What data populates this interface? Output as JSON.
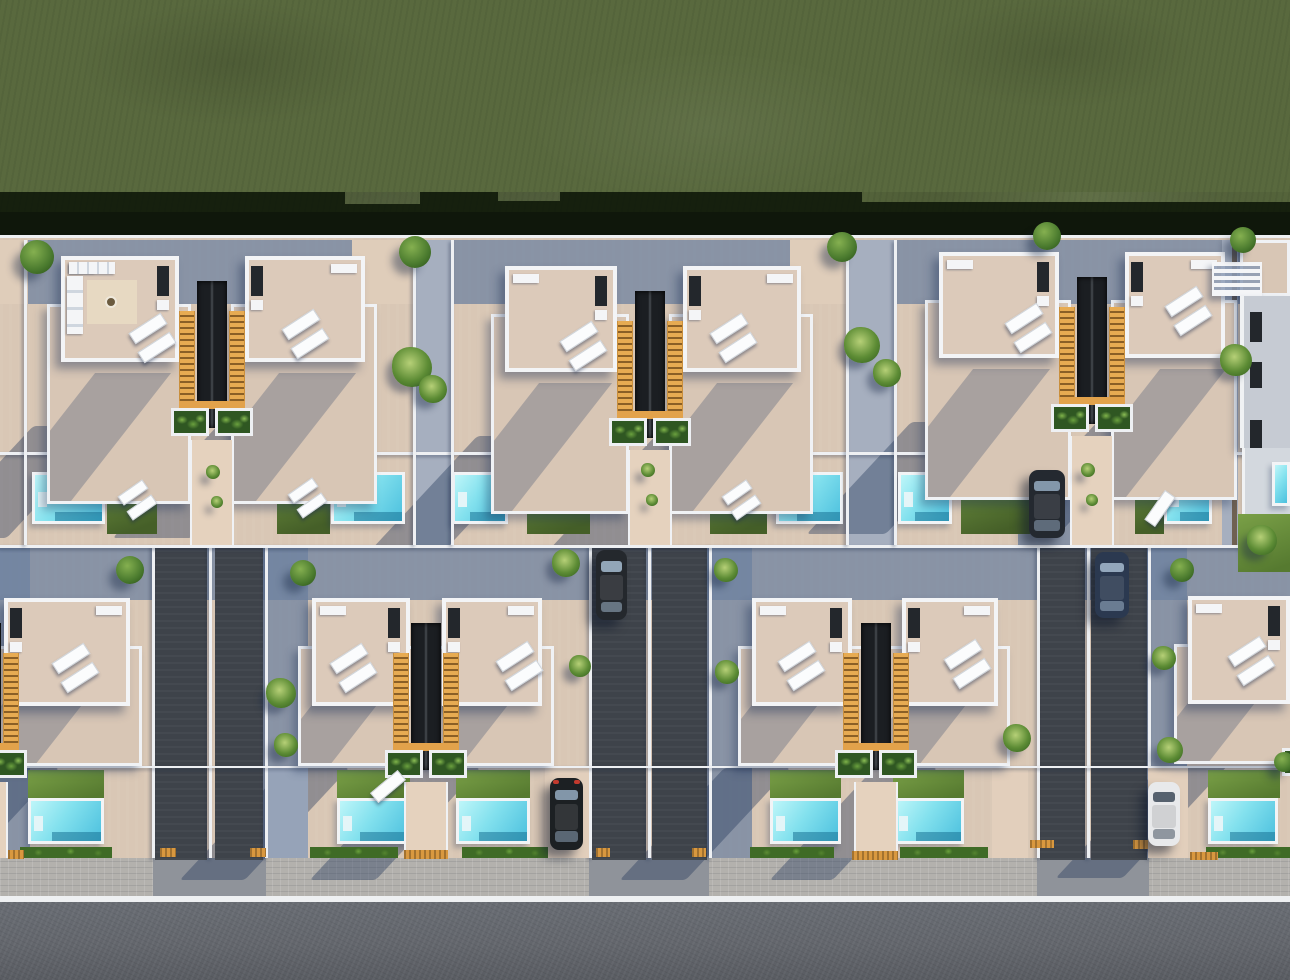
{
  "meta": {
    "title": "aerial-top-down-render-villa-development",
    "description": "Top-down 3D architectural render: green field above two rows of mirrored white villas with beige roof terraces, sun loungers, orange stair wells with planters, cyan pools with lawns, dark double driveways with parked cars, paver sidewalk and asphalt street at the bottom. Sun from upper right casts blue shadows to lower left.",
    "canvas": {
      "w": 1290,
      "h": 980
    }
  },
  "palette": {
    "grass": "#59693e",
    "grass_shadow": "#0c1608",
    "pavement_lit": "#d9c7b5",
    "pavement_shaded": "#6e82a0",
    "terrace_beige": "#d8c6b5",
    "roof_beige": "#dccaba",
    "wall_white": "#f0f2f5",
    "stair_orange": "#e7ab52",
    "stairwell_dark": "#1b1e22",
    "planter_green": "#2f5722",
    "pool_cyan_light": "#bef6f9",
    "pool_cyan_deep": "#4cc0de",
    "pool_step": "#1f7396",
    "lawn_green": "#6e9140",
    "hedge_green": "#3f6b26",
    "driveway_dark": "#3e434a",
    "sidewalk_gray": "#b3b1ad",
    "road_gray": "#63666c",
    "curb_white": "#eef0f2",
    "tactile_orange": "#d9983f",
    "car_dark_gray": "#24282d",
    "car_dark_blue": "#2b3950",
    "car_black": "#1c2023",
    "car_white": "#e8e9eb",
    "shadow_blue": "rgba(38,58,92,0.40)"
  },
  "scene": {
    "ground": [
      {
        "cls": "grass",
        "name": "grass-field",
        "x": 0,
        "y": 0,
        "w": 1290,
        "h": 212
      },
      {
        "cls": "grass-shadow",
        "name": "tree-line-shadow",
        "x": 0,
        "y": 192,
        "w": 1290,
        "h": 46
      },
      {
        "cls": "grass",
        "name": "grass-notch",
        "x": 345,
        "y": 192,
        "w": 75,
        "h": 12
      },
      {
        "cls": "grass",
        "name": "grass-notch",
        "x": 498,
        "y": 192,
        "w": 62,
        "h": 9
      },
      {
        "cls": "grass",
        "name": "grass-notch",
        "x": 862,
        "y": 192,
        "w": 428,
        "h": 10
      },
      {
        "cls": "wall",
        "name": "rear-boundary-wall",
        "x": 0,
        "y": 235,
        "w": 1290,
        "h": 4
      },
      {
        "cls": "dev",
        "name": "development-ground",
        "x": 0,
        "y": 238,
        "w": 1290,
        "h": 624
      },
      {
        "cls": "shadeband",
        "name": "row1-backyard-shade",
        "x": 0,
        "y": 240,
        "w": 1290,
        "h": 64
      },
      {
        "cls": "shadeband",
        "name": "row2-backyard-shade",
        "x": 0,
        "y": 548,
        "w": 1290,
        "h": 52
      },
      {
        "cls": "litpatch",
        "name": "backyard-lit-patch",
        "x": 352,
        "y": 240,
        "w": 62,
        "h": 64
      },
      {
        "cls": "litpatch",
        "name": "backyard-lit-patch",
        "x": 790,
        "y": 240,
        "w": 62,
        "h": 64
      },
      {
        "cls": "litpatch",
        "name": "backyard-lit-patch",
        "x": 0,
        "y": 240,
        "w": 28,
        "h": 64
      },
      {
        "cls": "shadeband",
        "name": "plot-shade-strip",
        "x": 263,
        "y": 548,
        "w": 45,
        "h": 310
      },
      {
        "cls": "shadeband",
        "name": "plot-shade-strip",
        "x": 707,
        "y": 548,
        "w": 45,
        "h": 310
      },
      {
        "cls": "shadeband",
        "name": "plot-shade-strip",
        "x": 1147,
        "y": 548,
        "w": 40,
        "h": 310
      },
      {
        "cls": "shadeband",
        "name": "plot-shade-strip",
        "x": 0,
        "y": 548,
        "w": 30,
        "h": 310
      },
      {
        "cls": "shadeband",
        "name": "carport-shade",
        "x": 1018,
        "y": 452,
        "w": 66,
        "h": 96
      },
      {
        "cls": "alley-lit",
        "name": "block-alley",
        "x": 415,
        "y": 240,
        "w": 36,
        "h": 305
      },
      {
        "cls": "alley-lit",
        "name": "block-alley",
        "x": 848,
        "y": 240,
        "w": 46,
        "h": 305
      },
      {
        "cls": "alley-lit",
        "name": "block-alley",
        "x": 1222,
        "y": 240,
        "w": 16,
        "h": 305
      },
      {
        "cls": "sidewalk",
        "name": "sidewalk",
        "x": 0,
        "y": 858,
        "w": 1290,
        "h": 40
      },
      {
        "cls": "apron",
        "name": "driveway-apron",
        "x": 153,
        "y": 858,
        "w": 113,
        "h": 38
      },
      {
        "cls": "apron",
        "name": "driveway-apron",
        "x": 589,
        "y": 858,
        "w": 120,
        "h": 38
      },
      {
        "cls": "apron",
        "name": "driveway-apron",
        "x": 1037,
        "y": 858,
        "w": 112,
        "h": 38
      },
      {
        "cls": "curb",
        "name": "curb-line",
        "x": 0,
        "y": 896,
        "w": 1290,
        "h": 6
      },
      {
        "cls": "road",
        "name": "street-asphalt",
        "x": 0,
        "y": 902,
        "w": 1290,
        "h": 78
      }
    ],
    "driveways": [
      {
        "x": 155,
        "y": 545,
        "w": 52,
        "h": 315
      },
      {
        "x": 215,
        "y": 545,
        "w": 48,
        "h": 315
      },
      {
        "x": 592,
        "y": 545,
        "w": 54,
        "h": 315
      },
      {
        "x": 652,
        "y": 545,
        "w": 55,
        "h": 315
      },
      {
        "x": 1040,
        "y": 545,
        "w": 45,
        "h": 315
      },
      {
        "x": 1091,
        "y": 545,
        "w": 56,
        "h": 315
      }
    ],
    "drive_walls_x": [
      152,
      209,
      265,
      589,
      648,
      709,
      1037,
      1087,
      1148
    ],
    "short_drives": [
      {
        "x": 545,
        "y": 768,
        "w": 44,
        "h": 90,
        "lit": true
      },
      {
        "x": 992,
        "y": 770,
        "w": 36,
        "h": 88,
        "lit": true
      },
      {
        "x": 1148,
        "y": 768,
        "w": 40,
        "h": 90,
        "lit": true
      },
      {
        "x": 268,
        "y": 768,
        "w": 40,
        "h": 90,
        "lit": false
      }
    ],
    "villas": [
      {
        "x": 61,
        "y": 256,
        "w": 118,
        "row": 1,
        "stairs": "right",
        "kitchen": true
      },
      {
        "x": 245,
        "y": 256,
        "w": 120,
        "row": 1,
        "stairs": "left"
      },
      {
        "x": 505,
        "y": 266,
        "w": 112,
        "row": 1,
        "stairs": "right"
      },
      {
        "x": 683,
        "y": 266,
        "w": 118,
        "row": 1,
        "stairs": "left"
      },
      {
        "x": 939,
        "y": 252,
        "w": 120,
        "row": 1,
        "stairs": "right"
      },
      {
        "x": 1125,
        "y": 252,
        "w": 100,
        "row": 1,
        "stairs": "left"
      },
      {
        "x": 4,
        "y": 598,
        "w": 126,
        "row": 2,
        "stairs": "left"
      },
      {
        "x": 312,
        "y": 598,
        "w": 98,
        "row": 2,
        "stairs": "right"
      },
      {
        "x": 442,
        "y": 598,
        "w": 100,
        "row": 2,
        "stairs": "left"
      },
      {
        "x": 752,
        "y": 598,
        "w": 100,
        "row": 2,
        "stairs": "right"
      },
      {
        "x": 902,
        "y": 598,
        "w": 96,
        "row": 2,
        "stairs": "left"
      },
      {
        "x": 1188,
        "y": 596,
        "w": 102,
        "row": 2,
        "stairs": "right"
      }
    ],
    "pair_modules": [
      {
        "cx": 212,
        "y": 256,
        "row": 1
      },
      {
        "cx": 650,
        "y": 266,
        "row": 1
      },
      {
        "cx": 1092,
        "y": 252,
        "row": 1
      },
      {
        "cx": -14,
        "y": 598,
        "row": 2
      },
      {
        "cx": 426,
        "y": 598,
        "row": 2
      },
      {
        "cx": 876,
        "y": 598,
        "row": 2
      },
      {
        "cx": 1323,
        "y": 596,
        "row": 2
      }
    ],
    "pools": [
      {
        "x": 32,
        "y": 472,
        "w": 73,
        "h": 52
      },
      {
        "x": 331,
        "y": 472,
        "w": 74,
        "h": 52
      },
      {
        "x": 452,
        "y": 472,
        "w": 56,
        "h": 52
      },
      {
        "x": 776,
        "y": 472,
        "w": 67,
        "h": 52
      },
      {
        "x": 898,
        "y": 472,
        "w": 54,
        "h": 52
      },
      {
        "x": 1164,
        "y": 472,
        "w": 48,
        "h": 52
      },
      {
        "x": 1246,
        "y": 428,
        "w": 44,
        "h": 92
      },
      {
        "x": 28,
        "y": 798,
        "w": 76,
        "h": 46
      },
      {
        "x": 337,
        "y": 798,
        "w": 73,
        "h": 46
      },
      {
        "x": 456,
        "y": 798,
        "w": 74,
        "h": 46
      },
      {
        "x": 770,
        "y": 798,
        "w": 71,
        "h": 46
      },
      {
        "x": 893,
        "y": 798,
        "w": 71,
        "h": 46
      },
      {
        "x": 1208,
        "y": 798,
        "w": 70,
        "h": 46
      }
    ],
    "lawns": [
      {
        "x": 107,
        "y": 472,
        "w": 50,
        "h": 62,
        "row": 1
      },
      {
        "x": 277,
        "y": 472,
        "w": 53,
        "h": 62,
        "row": 1
      },
      {
        "x": 527,
        "y": 472,
        "w": 63,
        "h": 62,
        "row": 1
      },
      {
        "x": 710,
        "y": 472,
        "w": 57,
        "h": 62,
        "row": 1
      },
      {
        "x": 961,
        "y": 472,
        "w": 69,
        "h": 62,
        "row": 1
      },
      {
        "x": 1135,
        "y": 472,
        "w": 29,
        "h": 62,
        "row": 1
      },
      {
        "x": 28,
        "y": 770,
        "w": 76,
        "h": 28,
        "row": 2
      },
      {
        "x": 337,
        "y": 770,
        "w": 73,
        "h": 28,
        "row": 2
      },
      {
        "x": 456,
        "y": 770,
        "w": 74,
        "h": 28,
        "row": 2
      },
      {
        "x": 770,
        "y": 770,
        "w": 71,
        "h": 28,
        "row": 2
      },
      {
        "x": 893,
        "y": 770,
        "w": 71,
        "h": 28,
        "row": 2
      },
      {
        "x": 1208,
        "y": 770,
        "w": 72,
        "h": 28,
        "row": 2
      }
    ],
    "hedges": [
      {
        "x": 20,
        "y": 847,
        "w": 92,
        "h": 11
      },
      {
        "x": 310,
        "y": 847,
        "w": 88,
        "h": 11
      },
      {
        "x": 462,
        "y": 847,
        "w": 86,
        "h": 11
      },
      {
        "x": 750,
        "y": 847,
        "w": 84,
        "h": 11
      },
      {
        "x": 900,
        "y": 847,
        "w": 88,
        "h": 11
      },
      {
        "x": 1206,
        "y": 847,
        "w": 84,
        "h": 11
      }
    ],
    "lounger_pairs": [
      {
        "x": 129,
        "y": 322,
        "r": -33
      },
      {
        "x": 282,
        "y": 318,
        "r": -33
      },
      {
        "x": 560,
        "y": 330,
        "r": -33
      },
      {
        "x": 710,
        "y": 322,
        "r": -33
      },
      {
        "x": 1005,
        "y": 312,
        "r": -33
      },
      {
        "x": 1165,
        "y": 295,
        "r": -33
      },
      {
        "x": 52,
        "y": 652,
        "r": -33
      },
      {
        "x": 330,
        "y": 652,
        "r": -33
      },
      {
        "x": 496,
        "y": 650,
        "r": -33
      },
      {
        "x": 778,
        "y": 650,
        "r": -33
      },
      {
        "x": 944,
        "y": 648,
        "r": -33
      },
      {
        "x": 1228,
        "y": 645,
        "r": -33
      },
      {
        "x": 118,
        "y": 487,
        "r": -35,
        "small": true
      },
      {
        "x": 288,
        "y": 485,
        "r": -35,
        "small": true
      },
      {
        "x": 722,
        "y": 487,
        "r": -35,
        "small": true
      }
    ],
    "lounger_singles": [
      {
        "x": 1142,
        "y": 502,
        "r": -55
      },
      {
        "x": 370,
        "y": 780,
        "r": -40
      },
      {
        "x": 752,
        "y": 880,
        "r": 0,
        "skip": true
      }
    ],
    "walls_h": [
      {
        "x": 0,
        "y": 452,
        "w": 1290,
        "h": 3
      },
      {
        "x": 0,
        "y": 545,
        "w": 1290,
        "h": 3
      },
      {
        "x": 0,
        "y": 766,
        "w": 1290,
        "h": 2
      }
    ],
    "walls_v": [
      {
        "x": 24,
        "y": 240,
        "w": 3,
        "h": 305
      },
      {
        "x": 413,
        "y": 240,
        "w": 3,
        "h": 305
      },
      {
        "x": 451,
        "y": 240,
        "w": 3,
        "h": 305
      },
      {
        "x": 846,
        "y": 240,
        "w": 3,
        "h": 305
      },
      {
        "x": 894,
        "y": 240,
        "w": 3,
        "h": 305
      }
    ],
    "alley_wall_dark": {
      "x": 1232,
      "y": 240,
      "w": 5,
      "h": 305
    },
    "pads": [
      {
        "x": 160,
        "y": 848,
        "w": 16,
        "h": 9
      },
      {
        "x": 250,
        "y": 848,
        "w": 16,
        "h": 9
      },
      {
        "x": 596,
        "y": 848,
        "w": 14,
        "h": 9
      },
      {
        "x": 692,
        "y": 848,
        "w": 14,
        "h": 9
      },
      {
        "x": 1030,
        "y": 840,
        "w": 24,
        "h": 8
      },
      {
        "x": 404,
        "y": 850,
        "w": 44,
        "h": 9
      },
      {
        "x": 852,
        "y": 851,
        "w": 46,
        "h": 9
      },
      {
        "x": 1133,
        "y": 840,
        "w": 15,
        "h": 9
      },
      {
        "x": 1190,
        "y": 852,
        "w": 28,
        "h": 8
      },
      {
        "x": 8,
        "y": 850,
        "w": 16,
        "h": 9
      }
    ],
    "cars": [
      {
        "x": 596,
        "y": 550,
        "w": 31,
        "h": 70,
        "body": "#24282d",
        "glass": "#9fb4c8"
      },
      {
        "x": 1095,
        "y": 552,
        "w": 34,
        "h": 66,
        "body": "#2b3950",
        "glass": "#9fb4c8"
      },
      {
        "x": 1029,
        "y": 470,
        "w": 36,
        "h": 68,
        "body": "#242930",
        "glass": "#8ea3b8"
      },
      {
        "x": 550,
        "y": 778,
        "w": 33,
        "h": 72,
        "body": "#1c2023",
        "glass": "#8ea3b8",
        "tail": true
      },
      {
        "x": 1148,
        "y": 782,
        "w": 32,
        "h": 64,
        "body": "#e8e9eb",
        "glass": "#465261"
      }
    ],
    "trees": [
      {
        "x": 37,
        "y": 257,
        "r": 17,
        "k": "t"
      },
      {
        "x": 415,
        "y": 252,
        "r": 16,
        "k": "t"
      },
      {
        "x": 842,
        "y": 247,
        "r": 15,
        "k": "t"
      },
      {
        "x": 1047,
        "y": 236,
        "r": 14,
        "k": "t"
      },
      {
        "x": 1243,
        "y": 240,
        "r": 13,
        "k": "t"
      },
      {
        "x": 412,
        "y": 367,
        "r": 20,
        "k": "p"
      },
      {
        "x": 433,
        "y": 389,
        "r": 14,
        "k": "p"
      },
      {
        "x": 862,
        "y": 345,
        "r": 18,
        "k": "p"
      },
      {
        "x": 887,
        "y": 373,
        "r": 14,
        "k": "p"
      },
      {
        "x": 1236,
        "y": 360,
        "r": 16,
        "k": "p"
      },
      {
        "x": 130,
        "y": 570,
        "r": 14,
        "k": "t"
      },
      {
        "x": 303,
        "y": 573,
        "r": 13,
        "k": "t"
      },
      {
        "x": 1182,
        "y": 570,
        "r": 12,
        "k": "t"
      },
      {
        "x": 566,
        "y": 563,
        "r": 14,
        "k": "p"
      },
      {
        "x": 580,
        "y": 666,
        "r": 11,
        "k": "p"
      },
      {
        "x": 726,
        "y": 570,
        "r": 12,
        "k": "p"
      },
      {
        "x": 727,
        "y": 672,
        "r": 12,
        "k": "p"
      },
      {
        "x": 281,
        "y": 693,
        "r": 15,
        "k": "p"
      },
      {
        "x": 286,
        "y": 745,
        "r": 12,
        "k": "p"
      },
      {
        "x": 1017,
        "y": 738,
        "r": 14,
        "k": "p"
      },
      {
        "x": 1164,
        "y": 658,
        "r": 12,
        "k": "p"
      },
      {
        "x": 1170,
        "y": 750,
        "r": 13,
        "k": "p"
      },
      {
        "x": 1262,
        "y": 540,
        "r": 15,
        "k": "p"
      },
      {
        "x": 1284,
        "y": 762,
        "r": 10,
        "k": "t"
      },
      {
        "x": 213,
        "y": 472,
        "r": 7,
        "k": "p"
      },
      {
        "x": 217,
        "y": 502,
        "r": 6,
        "k": "p"
      },
      {
        "x": 648,
        "y": 470,
        "r": 7,
        "k": "p"
      },
      {
        "x": 652,
        "y": 500,
        "r": 6,
        "k": "p"
      },
      {
        "x": 1088,
        "y": 470,
        "r": 7,
        "k": "p"
      },
      {
        "x": 1092,
        "y": 500,
        "r": 6,
        "k": "p"
      }
    ],
    "corner": {
      "pergola": {
        "x": 1212,
        "y": 262,
        "w": 50,
        "h": 34
      },
      "upper_terrace": {
        "x": 1240,
        "y": 240,
        "w": 50,
        "h": 56
      },
      "facade": {
        "x": 1240,
        "y": 296,
        "w": 50,
        "h": 152
      },
      "windows": [
        {
          "x": 1250,
          "y": 312,
          "w": 12,
          "h": 30
        },
        {
          "x": 1250,
          "y": 362,
          "w": 12,
          "h": 26
        },
        {
          "x": 1250,
          "y": 420,
          "w": 12,
          "h": 28
        }
      ],
      "lower": {
        "x": 1242,
        "y": 448,
        "w": 48,
        "h": 66
      },
      "pool_sliver": {
        "x": 1272,
        "y": 462,
        "w": 18,
        "h": 44
      },
      "grass_patch": {
        "x": 1238,
        "y": 514,
        "w": 52,
        "h": 58
      }
    }
  }
}
